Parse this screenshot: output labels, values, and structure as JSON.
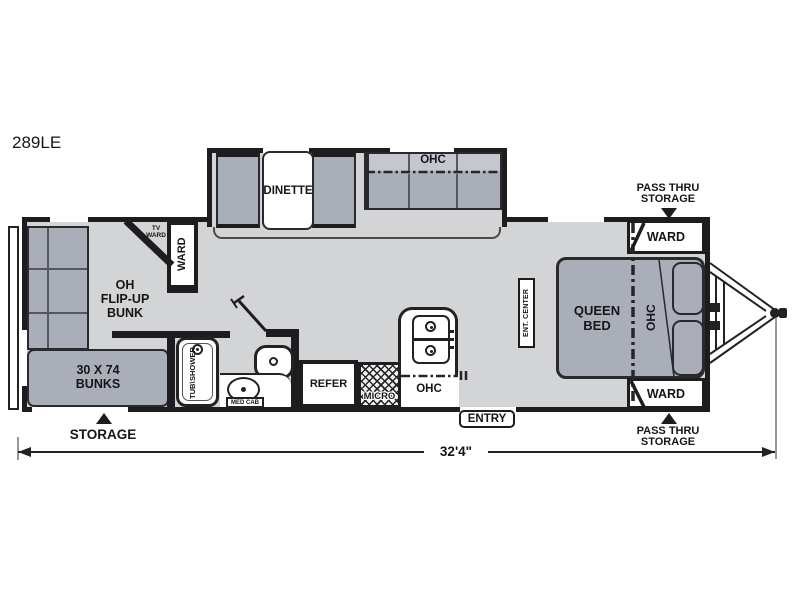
{
  "model": "289LE",
  "dimension_label": "32'4\"",
  "colors": {
    "wall": "#1d1d1f",
    "floor": "#d3d4d6",
    "furniture": "#a9aeb9",
    "sofa_top": "#c4c7cd"
  },
  "slideout": {
    "dinette": "DINETTE",
    "sofa_ohc": "OHC"
  },
  "rear": {
    "flip_bunk": [
      "OH",
      "FLIP-UP",
      "BUNK"
    ],
    "bunks": [
      "30 X 74",
      "BUNKS"
    ],
    "tv_ward": [
      "TV",
      "WARD"
    ],
    "ward": "WARD",
    "storage": "STORAGE"
  },
  "bath": {
    "tub": [
      "TUB\\",
      "SHOWER"
    ],
    "med_cab": "MED CAB"
  },
  "kitchen": {
    "refer": "REFER",
    "micro": "MICRO",
    "ohc": "OHC",
    "entry": "ENTRY"
  },
  "living": {
    "ent_center": "ENT. CENTER"
  },
  "front": {
    "queen": [
      "QUEEN",
      "BED"
    ],
    "ohc": "OHC",
    "ward_top": "WARD",
    "ward_bottom": "WARD",
    "pass_thru_top": [
      "PASS THRU",
      "STORAGE"
    ],
    "pass_thru_bottom": [
      "PASS THRU",
      "STORAGE"
    ]
  }
}
